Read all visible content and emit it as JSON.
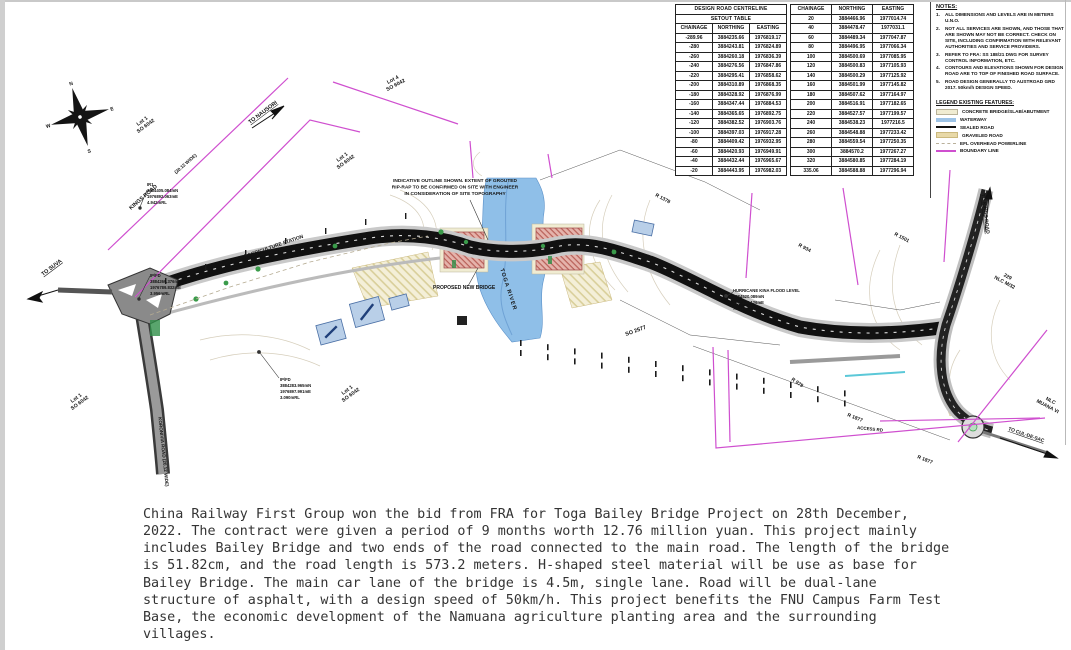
{
  "tables": {
    "table1": {
      "title_line1": "DESIGN ROAD CENTRELINE",
      "title_line2": "SETOUT TABLE",
      "headers": [
        "CHAINAGE",
        "NORTHING",
        "EASTING"
      ],
      "rows": [
        [
          "-289.96",
          "3884235.66",
          "1976819.17"
        ],
        [
          "-280",
          "3884243.81",
          "1976824.89"
        ],
        [
          "-260",
          "3884260.18",
          "1976836.39"
        ],
        [
          "-240",
          "3884276.56",
          "1976847.86"
        ],
        [
          "-220",
          "3884295.41",
          "1976858.62"
        ],
        [
          "-200",
          "3884310.89",
          "1976868.35"
        ],
        [
          "-180",
          "3884328.92",
          "1976876.99"
        ],
        [
          "-160",
          "3884347.44",
          "1976884.53"
        ],
        [
          "-140",
          "3884365.65",
          "1976892.75"
        ],
        [
          "-120",
          "3884382.52",
          "1976903.76"
        ],
        [
          "-100",
          "3884397.03",
          "1976917.28"
        ],
        [
          "-80",
          "3884409.42",
          "1976932.95"
        ],
        [
          "-60",
          "3884420.93",
          "1976949.91"
        ],
        [
          "-40",
          "3884432.44",
          "1976965.67"
        ],
        [
          "-20",
          "3884443.95",
          "1976982.03"
        ]
      ]
    },
    "table2": {
      "headers": [
        "CHAINAGE",
        "NORTHING",
        "EASTING"
      ],
      "rows": [
        [
          "20",
          "3884466.96",
          "1977014.74"
        ],
        [
          "40",
          "3884478.47",
          "1977031.1"
        ],
        [
          "60",
          "3884489.34",
          "1977047.87"
        ],
        [
          "80",
          "3884496.95",
          "1977066.34"
        ],
        [
          "100",
          "3884500.69",
          "1977085.95"
        ],
        [
          "120",
          "3884500.83",
          "1977105.93"
        ],
        [
          "140",
          "3884500.29",
          "1977125.92"
        ],
        [
          "160",
          "3884501.99",
          "1977145.82"
        ],
        [
          "180",
          "3884507.62",
          "1977164.97"
        ],
        [
          "200",
          "3884516.91",
          "1977182.65"
        ],
        [
          "220",
          "3884527.57",
          "1977199.57"
        ],
        [
          "240",
          "3884538.23",
          "1977216.5"
        ],
        [
          "260",
          "3884548.88",
          "1977233.42"
        ],
        [
          "280",
          "3884559.54",
          "1977250.35"
        ],
        [
          "300",
          "3884570.2",
          "1977267.27"
        ],
        [
          "320",
          "3884580.85",
          "1977284.19"
        ],
        [
          "335.06",
          "3884588.88",
          "1977296.94"
        ]
      ]
    }
  },
  "notes": {
    "title": "NOTES:",
    "items": [
      "ALL DIMENSIONS AND LEVELS ARE IN METERS U.N.O.",
      "NOT ALL SERVICES ARE SHOWN, AND THOSE THAT ARE SHOWN MAY NOT BE CORRECT.  CHECK ON SITE, INCLUDING CONFIRMATION WITH RELEVANT AUTHORITIES AND SERVICE PROVIDERS.",
      "REFER TO FRA: SS 188/21 DWG FOR SURVEY CONTROL INFORMATION, ETC.",
      "CONTOURS AND ELEVATIONS SHOWN FOR DESIGN ROAD ARE TO TOP OF FINISHED ROAD SURFACE.",
      "ROAD DESIGN GENERALLY TO AUSTROAD GRD 2017. 50km/h DESIGN SPEED."
    ]
  },
  "legend": {
    "title": "LEGEND EXISTING FEATURES:",
    "items": [
      {
        "label": "CONCRETE BRIDGE/SLAB/ABUTMENT",
        "swatch": "concrete"
      },
      {
        "label": "WATERWAY",
        "swatch": "waterway"
      },
      {
        "label": "SEALED ROAD",
        "swatch": "sealed"
      },
      {
        "label": "GRAVELED ROAD",
        "swatch": "graveled"
      },
      {
        "label": "EFL OVERHEAD POWERLINE",
        "swatch": "efl"
      },
      {
        "label": "BOUNDARY LINE",
        "swatch": "boundary"
      }
    ]
  },
  "map": {
    "to_suva": "TO SUVA",
    "to_nausori": "TO NAUSORI",
    "kings_road": "KINGS ROAD",
    "kings_road_width": "(20.12 WIDE)",
    "koronivia_road": "KORONIVIA ROAD (20.12 WIDE)",
    "koronivia_station": "KORONIVIA AGRICULTURE STATION",
    "lot1": "Lot 1",
    "lot4": "Lot 4",
    "so_6042": "SO 6042",
    "so_2577": "SO 2577",
    "ir1": [
      "IR1",
      "3884405.084mN",
      "1976892.063mE",
      "4.942mRL"
    ],
    "ipfd_west": [
      "IP/FD",
      "3884269.376mN",
      "1976789.832mE",
      "3.956mRL"
    ],
    "ipfd_south": [
      "IP/FD",
      "3884283.965mN",
      "1976897.991mE",
      "3.090mRL"
    ],
    "indicative_note": [
      "INDICATIVE OUTLINE SHOWN. EXTENT OF GROUTED",
      "RIP-RAP TO BE CONFIRMED ON SITE WITH ENGINEER",
      "IN CONSIDERATION OF SITE TOPOGRAPHY"
    ],
    "proposed_new_bridge": "PROPOSED NEW BRIDGE",
    "toga_river": "TOGA RIVER",
    "hurricane": [
      "HURRICANE KINA FLOOD LEVEL",
      "3884520.089mN",
      "1977146.126mE",
      "7.044mRL"
    ],
    "r_1378": "R 1378",
    "r_934": "R 934",
    "r_1501": "R 1501",
    "r_979": "R 979",
    "r_1877": "R 1877",
    "access_rd": "ACCESS RD",
    "nlc_229": [
      "229",
      "NLC M/32"
    ],
    "nlc_muana": [
      "NLC",
      "MUANA VI"
    ],
    "to_kings_road": "TO KINGS ROAD",
    "to_cul_de_sac": "TO CUL-DE-SAC"
  },
  "description": {
    "text": "China Railway First Group won the bid from FRA for Toga Bailey Bridge Project on 28th December, 2022. The contract were given a period of 9 months worth 12.76 million yuan. This project mainly includes Bailey Bridge and two ends of the road connected to the main road. The length of the bridge is 51.82cm, and the road length is 573.2 meters. H-shaped steel material will be use as base for Bailey Bridge. The main car lane of the bridge is 4.5m, single lane. Road will be dual-lane structure of asphalt, with a design speed of 50km/h. This project benefits the FNU Campus Farm Test Base, the economic development of the Namuana agriculture planting area and the surrounding villages."
  },
  "colors": {
    "boundary": "#cf4fcf",
    "waterway": "#8fbfe8",
    "gravel_hatch": "#d9cf9a",
    "concrete": "#f0ecd2",
    "abutment_hatch": "#b86058",
    "sealed_road": "#111111"
  }
}
